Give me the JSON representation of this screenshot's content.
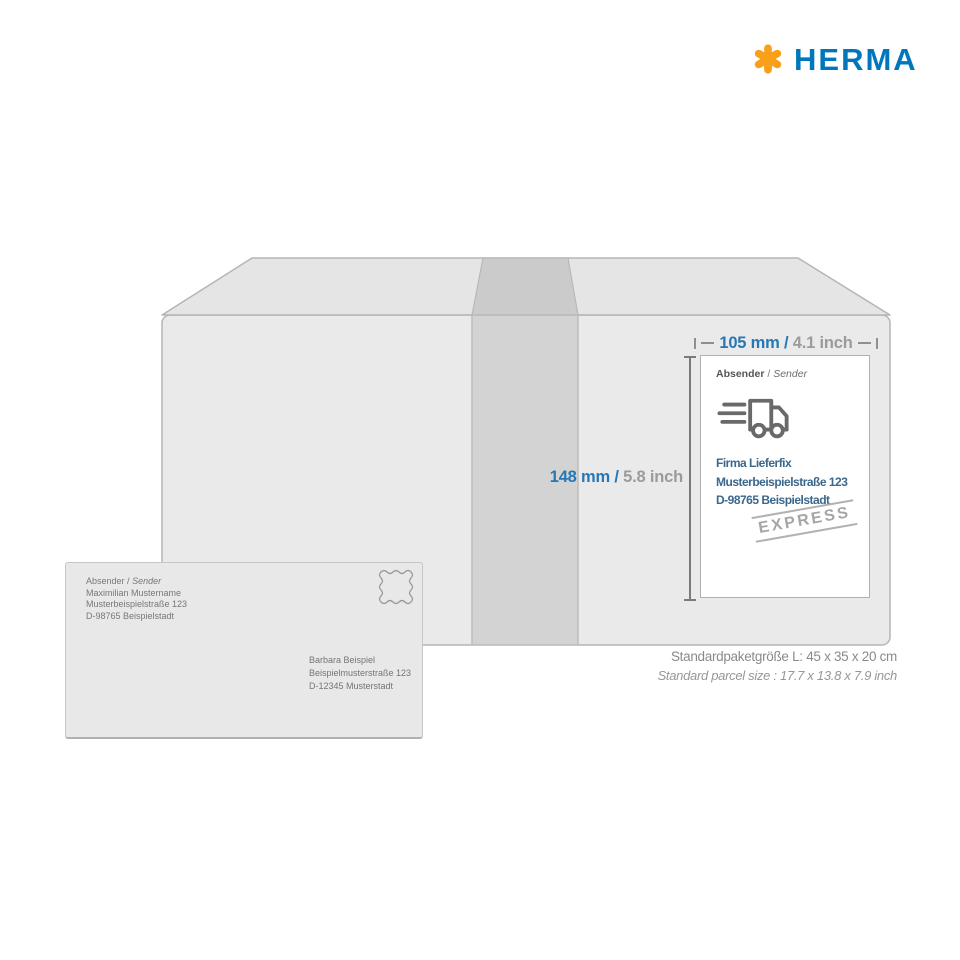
{
  "logo": {
    "brand": "HERMA"
  },
  "dimensions": {
    "width": {
      "metric": "105 mm",
      "separator": "/",
      "imperial": "4.1 inch"
    },
    "height": {
      "metric": "148 mm",
      "separator": "/",
      "imperial": "5.8 inch"
    }
  },
  "shipping_label": {
    "header": {
      "de": "Absender",
      "separator": "/",
      "en": "Sender"
    },
    "address": {
      "company": "Firma Lieferfix",
      "street": "Musterbeispielstraße 123",
      "city": "D-98765 Beispielstadt"
    },
    "stamp_text": "EXPRESS",
    "truck_icon": "delivery-truck-icon"
  },
  "envelope": {
    "sender_header": {
      "de": "Absender",
      "separator": "/",
      "en": "Sender"
    },
    "sender": {
      "name": "Maximilian Mustername",
      "street": "Musterbeispielstraße 123",
      "city": "D-98765 Beispielstadt"
    },
    "recipient": {
      "name": "Barbara Beispiel",
      "street": "Beispielmusterstraße 123",
      "city": "D-12345 Musterstadt"
    },
    "stamp_icon": "postage-stamp-outline"
  },
  "caption": {
    "metric": "Standardpaketgröße L: 45 x 35 x 20 cm",
    "imperial": "Standard parcel size : 17.7 x 13.8 x 7.9 inch"
  },
  "colors": {
    "brand_blue": "#0077BD",
    "brand_orange": "#F9A01B",
    "dimension_blue": "#2578B5",
    "label_address_blue": "#3A678C",
    "box_gray": "#EAEAEA",
    "tape_gray": "#CCCCCC"
  }
}
